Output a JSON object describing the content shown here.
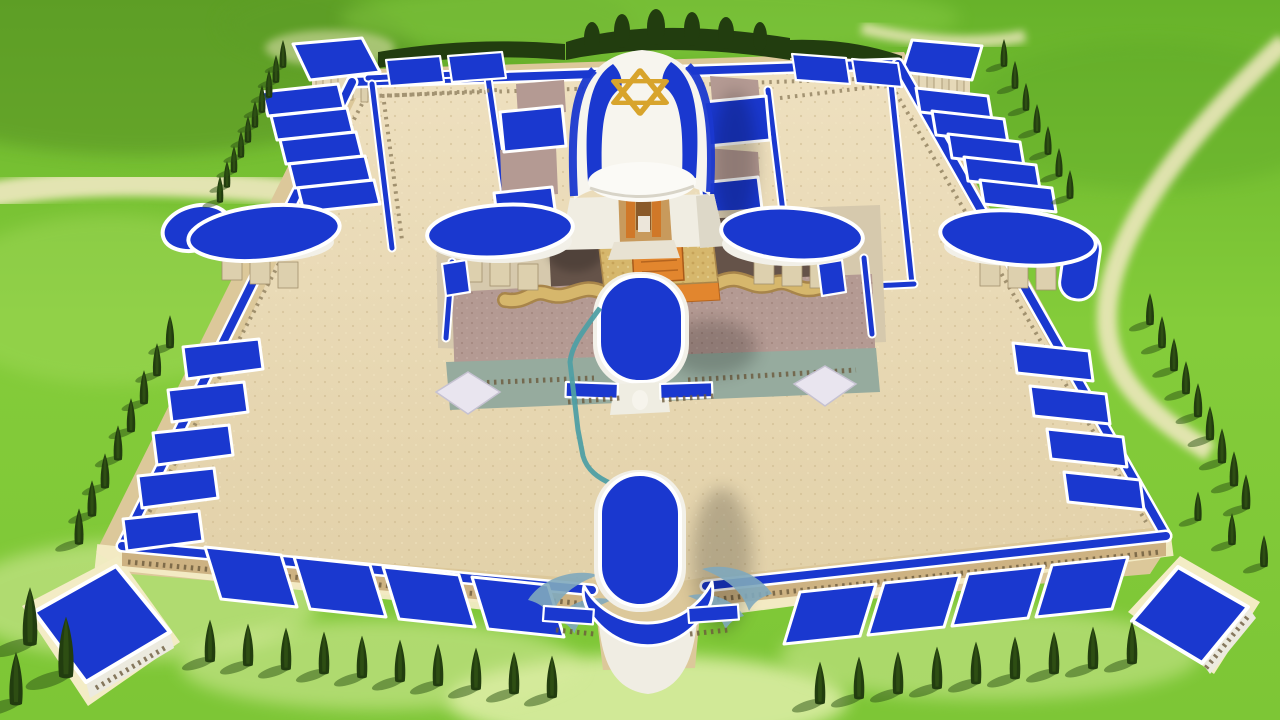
{
  "scene": {
    "description": "Aerial 3D render of a temple complex: royal-blue roofs with white trim, central sanctuary draped in an Israeli-flag style roof with a gold Star of David, sandy courtyards, colonnaded walls, bean-shaped gate canopies, capsule gatehouses, golden altar with serpentine ramps, and rows of dark cypress trees on bright green lawns crossed by cream footpaths.",
    "landmarks": {
      "sanctuary": "central sanctuary with flag roof",
      "star": "gold Star of David",
      "altar": "golden altar with orange hearth",
      "inner_court": "inner court with mauve gravel and dark pavement",
      "outer_court": "sandy outer court",
      "south_inner_gate": "south inner capsule gate",
      "south_outer_gate": "south outer capsule gate",
      "west_gate": "west bean-canopy gate",
      "east_gate": "east bean-canopy gate",
      "corner_pavilions": "square corner pavilions",
      "garden_pavilions": "small garden pavilions",
      "cypress_rows": "rows of cypress trees",
      "water_channel": "teal water channel"
    }
  },
  "colors": {
    "grass_top": "#5fae26",
    "grass_mid": "#83cb3a",
    "grass_low": "#7dc636",
    "grass_pale": "#d8eb9e",
    "path_cream": "#efe8c0",
    "sand": "#e7d8b5",
    "sand_deep": "#dccaa0",
    "rim_tan": "#d8c190",
    "base_cream": "#f3ecc5",
    "wall_tan": "#cdb282",
    "roof_blue": "#1a38cf",
    "trim_white": "#ffffff",
    "court_base": "#d6c9ad",
    "gravel_mauve": "#b49a93",
    "pave_dark": "#655349",
    "stone_teal": "#96ab9e",
    "altar_gold": "#d6b76c",
    "altar_orange": "#e2862e",
    "serp_edge": "#a8854a",
    "star_gold": "#d8a42c",
    "temple_white": "#f7f5ee",
    "temple_shade": "#ddd8c8",
    "tree_dark": "#223d0f",
    "tree_shadow": "#2c5214",
    "swoosh_teal": "#7fa8bc",
    "channel_teal": "#4f9fa4",
    "col_stone": "#ddd0ae"
  }
}
